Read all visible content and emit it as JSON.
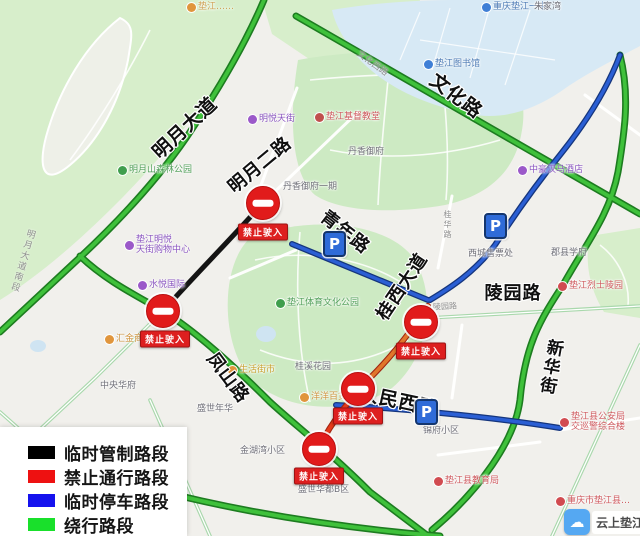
{
  "legend": {
    "items": [
      {
        "label": "临时管制路段",
        "color": "#000000"
      },
      {
        "label": "禁止通行路段",
        "color": "#ee1111"
      },
      {
        "label": "临时停车路段",
        "color": "#1512ee"
      },
      {
        "label": "绕行路段",
        "color": "#19e02b"
      }
    ]
  },
  "roads": {
    "wenhua": "文化路",
    "wenhua_xi": "文化西路",
    "mingyue_dadao": "明月大道",
    "mingyue_erlu": "明月二路",
    "qingnian": "青年路",
    "guixi_dadao": "桂西大道",
    "lingyuan": "陵园路",
    "lingyuan_small": "陵园路",
    "fengshan": "凤山路",
    "renmin_xilu": "人民西路",
    "xinhua_jie": "新华街",
    "mingyue_nanduan": "明月大道南段",
    "guihua": "桂华路"
  },
  "no_entry_label": "禁止驶入",
  "parking_letter": "P",
  "colors": {
    "route_control_black": "#141414",
    "route_forbidden_red": "#e2481f",
    "route_parking_blue": "#2b5fd4",
    "route_detour_green": "#3fc13b",
    "no_entry_sign_red": "#e11b1b",
    "parking_sign_blue": "#2f6bd8"
  },
  "pois": [
    {
      "text": "重庆垫江一中"
    },
    {
      "text": "朱家湾"
    },
    {
      "text": "垫江图书馆"
    },
    {
      "text": "垫江基督教堂"
    },
    {
      "text": "丹香御府"
    },
    {
      "text": "丹香御府一期"
    },
    {
      "text": "明悦天街"
    },
    {
      "text": "明月山森林公园"
    },
    {
      "text": "垫江明悦",
      "text2": "天街购物中心"
    },
    {
      "text": "水悦国际"
    },
    {
      "text": "汇金商业"
    },
    {
      "text": "中央华府"
    },
    {
      "text": "垫江体育文化公园"
    },
    {
      "text": "中豪汉马酒店"
    },
    {
      "text": "西城售票处"
    },
    {
      "text": "郡县学府"
    },
    {
      "text": "垫江烈士陵园"
    },
    {
      "text": "桂溪花园"
    },
    {
      "text": "生活街市"
    },
    {
      "text": "盛世年华"
    },
    {
      "text": "金湖湾小区"
    },
    {
      "text": "锦府小区"
    },
    {
      "text": "盛世华都B区"
    },
    {
      "text": "垫江县教育局"
    },
    {
      "text": "垫江县公安局",
      "text2": "交巡警综合楼"
    },
    {
      "text": "重庆市垫江县…"
    },
    {
      "text": "垫江……"
    },
    {
      "text": "洋洋百货"
    }
  ],
  "watermark": {
    "text": "云上垫江"
  }
}
